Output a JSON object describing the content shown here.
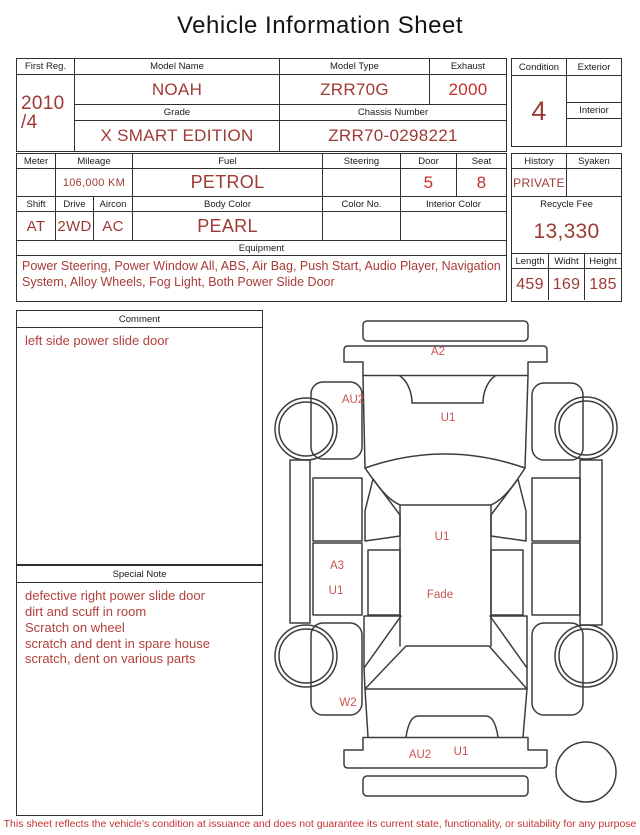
{
  "title": "Vehicle Information Sheet",
  "registration": {
    "first_reg_label": "First Reg.",
    "first_reg_year": "2010",
    "first_reg_month": "/4",
    "model_name_label": "Model Name",
    "model_name": "NOAH",
    "model_type_label": "Model Type",
    "model_type": "ZRR70G",
    "exhaust_label": "Exhaust",
    "exhaust": "2000",
    "grade_label": "Grade",
    "grade": "X SMART EDITION",
    "chassis_label": "Chassis Number",
    "chassis_number": "ZRR70-0298221"
  },
  "condition": {
    "condition_label": "Condition",
    "condition_grade": "4",
    "exterior_label": "Exterior",
    "exterior_grade": "",
    "interior_label": "Interior",
    "interior_grade": ""
  },
  "specs": {
    "meter_label": "Meter",
    "meter": "",
    "mileage_label": "Mileage",
    "mileage": "106,000 KM",
    "fuel_label": "Fuel",
    "fuel": "PETROL",
    "steering_label": "Steering",
    "steering": "",
    "door_label": "Door",
    "door": "5",
    "seat_label": "Seat",
    "seat": "8",
    "shift_label": "Shift",
    "shift": "AT",
    "drive_label": "Drive",
    "drive": "2WD",
    "aircon_label": "Aircon",
    "aircon": "AC",
    "body_color_label": "Body Color",
    "body_color": "PEARL",
    "color_no_label": "Color No.",
    "color_no": "",
    "interior_color_label": "Interior Color",
    "interior_color": ""
  },
  "history_box": {
    "history_label": "History",
    "history": "PRIVATE",
    "syaken_label": "Syaken",
    "syaken": "",
    "recycle_fee_label": "Recycle Fee",
    "recycle_fee": "13,330",
    "length_label": "Length",
    "length": "459",
    "width_label": "Widht",
    "width": "169",
    "height_label": "Height",
    "height": "185"
  },
  "equipment": {
    "label": "Equipment",
    "text": "Power Steering, Power Window  All, ABS, Air Bag, Push Start, Audio Player, Navigation System, Alloy Wheels, Fog Light, Both Power Slide Door"
  },
  "comment": {
    "label": "Comment",
    "text": "left side power slide door"
  },
  "special_note": {
    "label": "Special Note",
    "lines": [
      "defective right power slide door",
      "dirt and scuff in room",
      "Scratch on wheel",
      "scratch and dent in spare house",
      "scratch, dent on various parts"
    ]
  },
  "diagram": {
    "labels": [
      {
        "text": "A2",
        "position": "front-bumper"
      },
      {
        "text": "AU2",
        "position": "front-left-fender"
      },
      {
        "text": "U1",
        "position": "hood"
      },
      {
        "text": "U1",
        "position": "roof-front"
      },
      {
        "text": "A3",
        "position": "left-slide-door"
      },
      {
        "text": "U1",
        "position": "left-slide-door"
      },
      {
        "text": "Fade",
        "position": "roof-center"
      },
      {
        "text": "W2",
        "position": "rear-left-fender"
      },
      {
        "text": "AU2",
        "position": "rear-bumper"
      },
      {
        "text": "U1",
        "position": "rear-gate"
      }
    ]
  },
  "footer": "This sheet reflects the vehicle's condition at issuance and does not guarantee its current state, functionality, or suitability for any purpose",
  "colors": {
    "value_red": "#9e3a33",
    "bright_red": "#c5312d",
    "diagram_label_red": "#c9534e",
    "note_red": "#b2403c",
    "border_dark": "#2f2f2f"
  }
}
